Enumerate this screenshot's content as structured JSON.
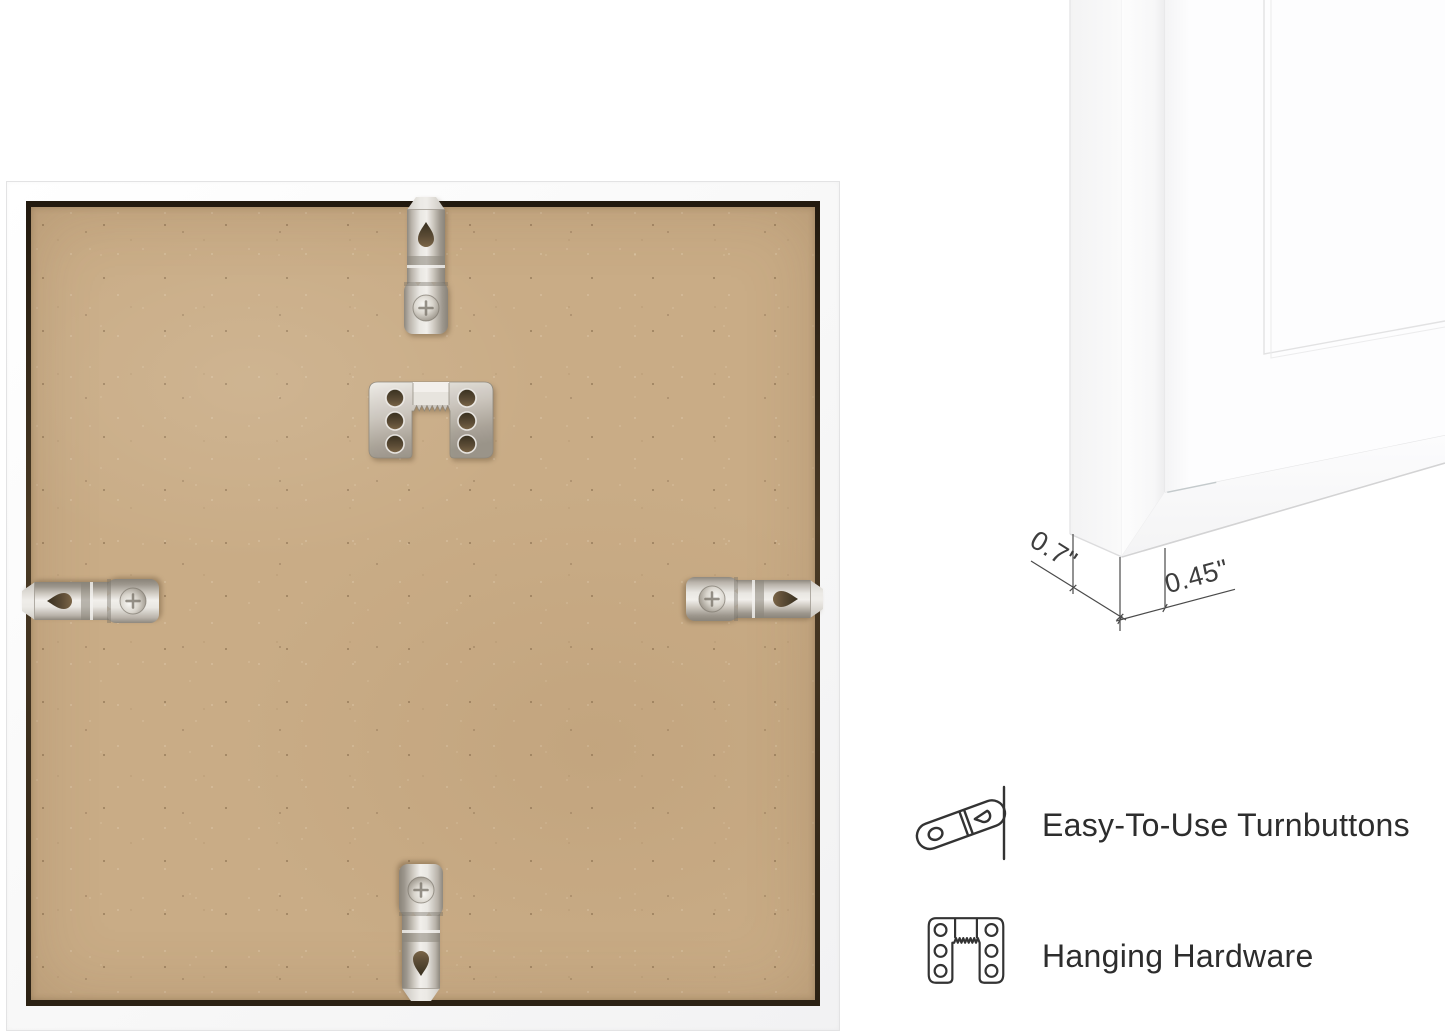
{
  "photo": {
    "subject": "picture frame back with mounting hardware",
    "board_color": "#c9ac86",
    "frame_color": "#fbfbfb",
    "metal_color": "#d6d2cb",
    "hardware": {
      "hanger": "sawtooth-hanger-plate",
      "turnbuttons": [
        "top",
        "left",
        "right",
        "bottom"
      ]
    }
  },
  "corner_detail": {
    "subject": "white frame corner with mat",
    "depth_label": "0.7\"",
    "moulding_width_label": "0.45\""
  },
  "features": [
    {
      "icon": "turnbutton-icon",
      "label": "Easy-To-Use Turnbuttons"
    },
    {
      "icon": "sawtooth-hanger-icon",
      "label": "Hanging Hardware"
    }
  ],
  "colors": {
    "text": "#2d2d2d",
    "dimension_lines": "#4a4a4a",
    "icon_stroke": "#333333"
  }
}
